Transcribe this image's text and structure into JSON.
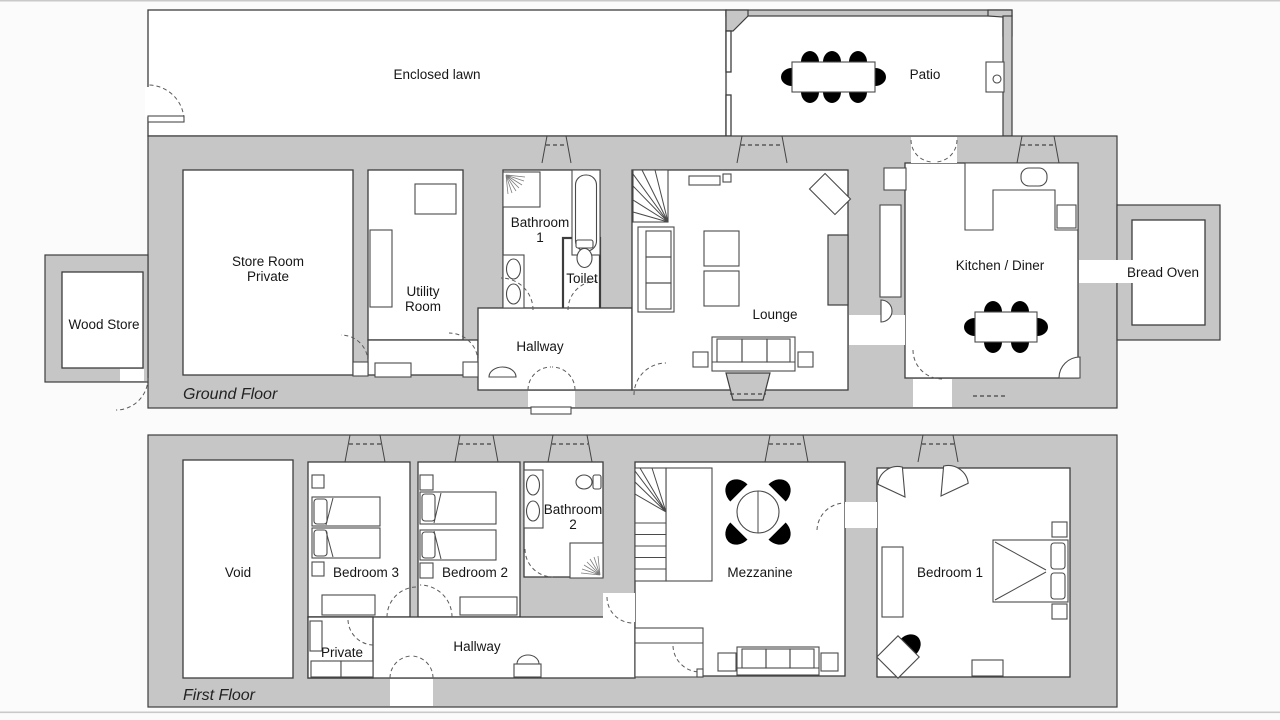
{
  "colors": {
    "wall": "#c6c6c6",
    "line": "#3d3d3d",
    "background": "#fbfbfb",
    "text": "#161616"
  },
  "ground_floor": {
    "floor_label": "Ground Floor",
    "rooms": {
      "enclosed_lawn": "Enclosed lawn",
      "patio": "Patio",
      "wood_store": "Wood Store",
      "store_room_line1": "Store Room",
      "store_room_line2": "Private",
      "utility_line1": "Utility",
      "utility_line2": "Room",
      "bathroom1_line1": "Bathroom",
      "bathroom1_line2": "1",
      "toilet": "Toilet",
      "hallway": "Hallway",
      "lounge": "Lounge",
      "kitchen": "Kitchen / Diner",
      "bread_oven": "Bread Oven"
    }
  },
  "first_floor": {
    "floor_label": "First Floor",
    "rooms": {
      "void": "Void",
      "bedroom3": "Bedroom 3",
      "bedroom2": "Bedroom 2",
      "bathroom2_line1": "Bathroom",
      "bathroom2_line2": "2",
      "private": "Private",
      "hallway": "Hallway",
      "mezzanine": "Mezzanine",
      "bedroom1": "Bedroom 1"
    }
  }
}
